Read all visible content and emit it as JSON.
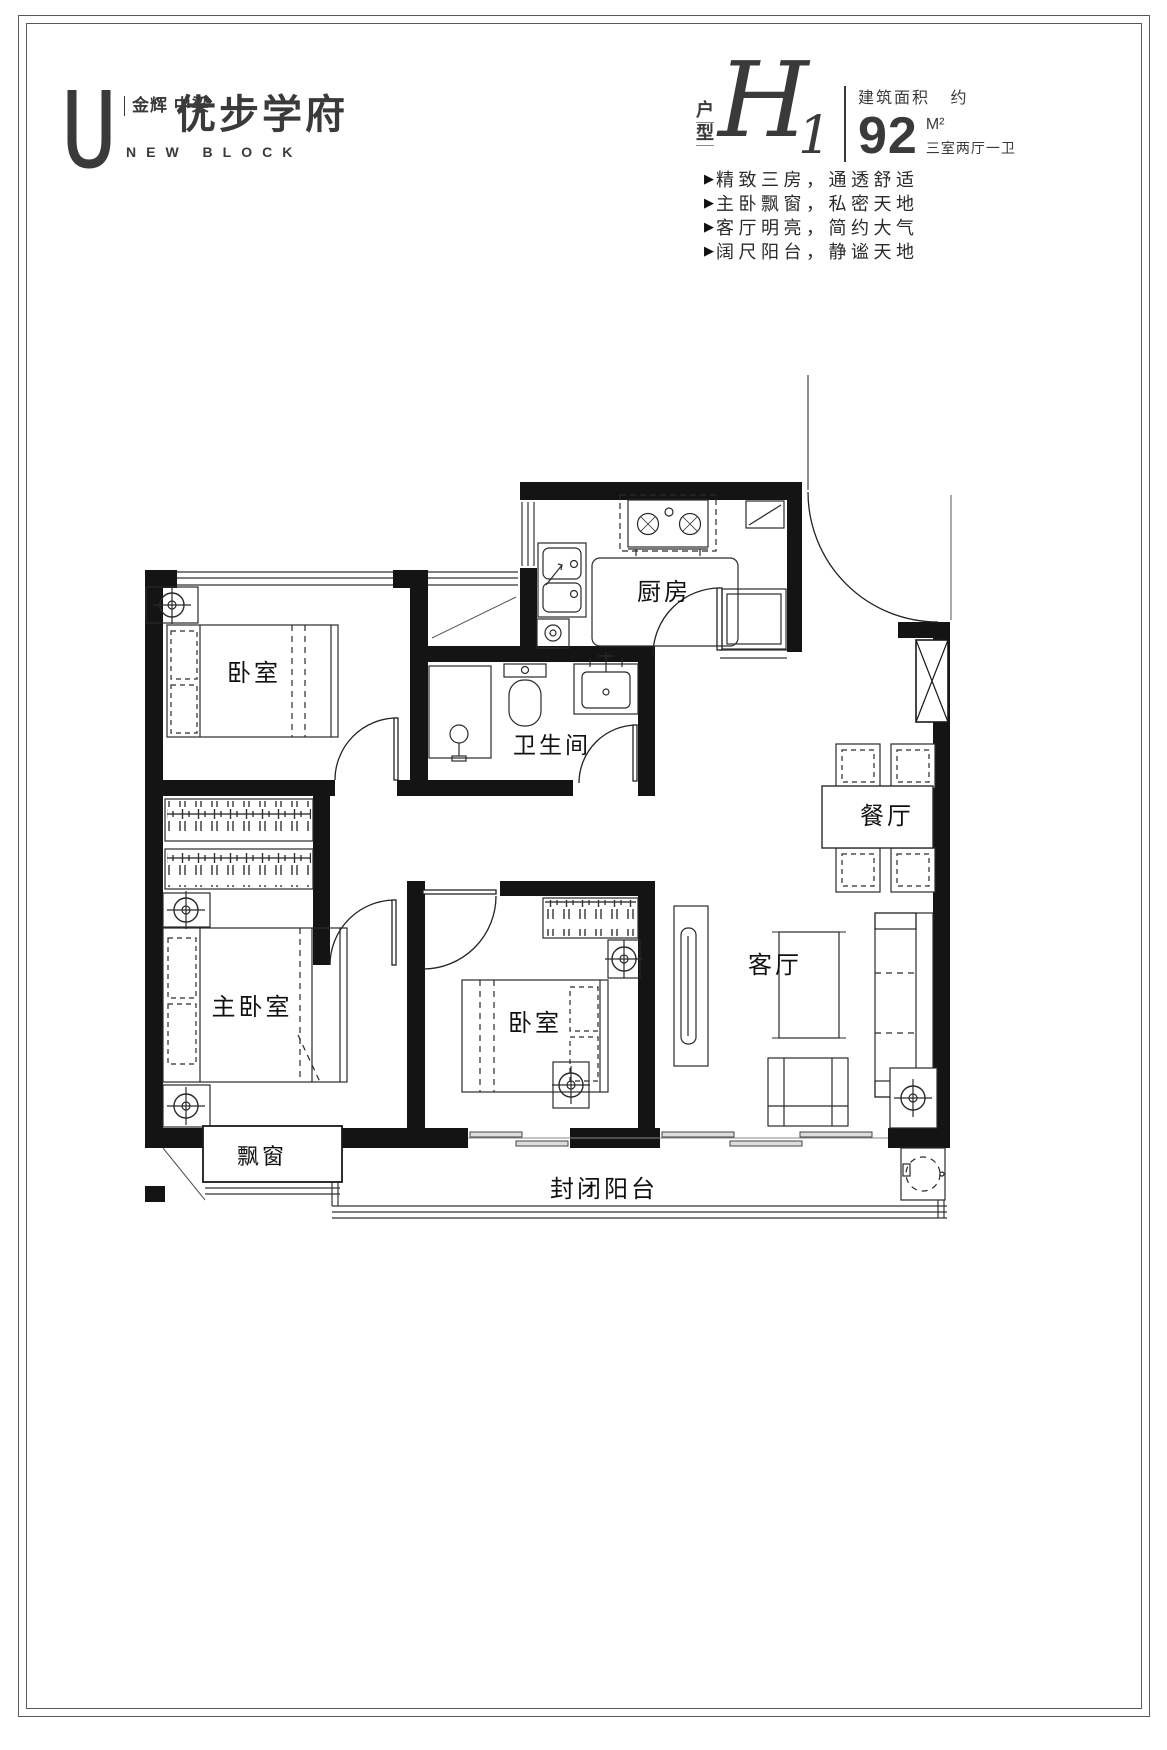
{
  "header": {
    "logo": {
      "brand_top": "金辉",
      "brand_bottom": "中梁",
      "name": "优步学府",
      "subtitle": "NEW BLOCK"
    },
    "unit": {
      "label_top": "户",
      "label_bottom": "型",
      "code_letter": "H",
      "code_number": "1",
      "area_label": "建筑面积",
      "area_approx": "约",
      "area_value": "92",
      "area_unit": "M²",
      "layout": "三室两厅一卫"
    },
    "bullet_char": "▶",
    "features": [
      "精致三房，通透舒适",
      "主卧飘窗，私密天地",
      "客厅明亮，简约大气",
      "阔尺阳台，静谧天地"
    ]
  },
  "floorplan": {
    "rooms": {
      "kitchen": "厨房",
      "bathroom": "卫生间",
      "dining": "餐厅",
      "living": "客厅",
      "bedroom1": "卧室",
      "bedroom2": "卧室",
      "master": "主卧室",
      "bay_window": "飘窗",
      "balcony": "封闭阳台"
    },
    "colors": {
      "wall": "#141414",
      "line": "#2a2a2a"
    }
  }
}
